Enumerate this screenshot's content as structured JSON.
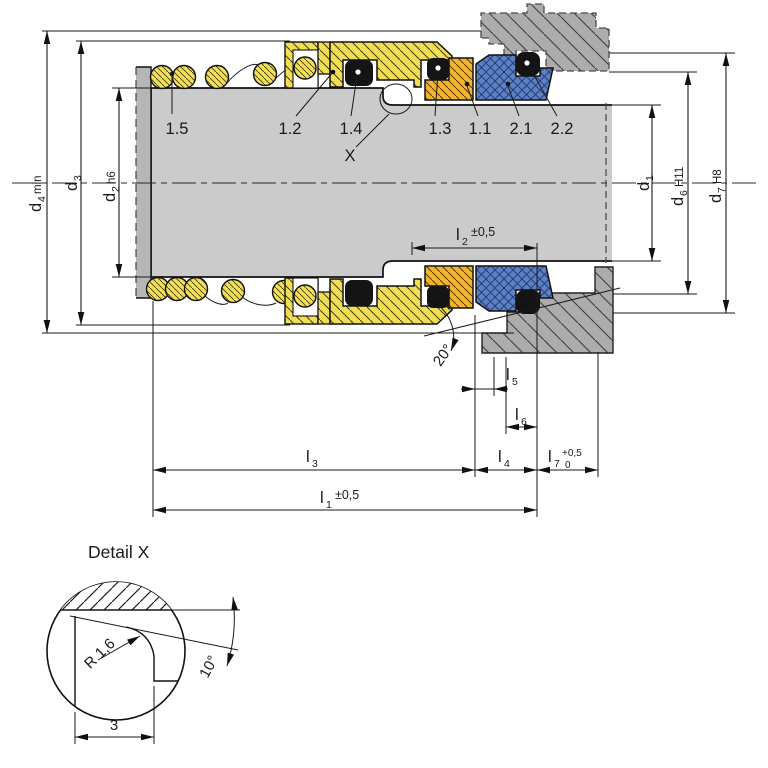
{
  "parts": {
    "p15": "1.5",
    "p12": "1.2",
    "p14": "1.4",
    "p13": "1.3",
    "p11": "1.1",
    "p21": "2.1",
    "p22": "2.2",
    "x_ref": "X"
  },
  "dims": {
    "d4": {
      "base": "d",
      "sub": "4",
      "tol": "min"
    },
    "d3": {
      "base": "d",
      "sub": "3",
      "tol": ""
    },
    "d2": {
      "base": "d",
      "sub": "2",
      "tol": "h6"
    },
    "d1": {
      "base": "d",
      "sub": "1",
      "tol": ""
    },
    "d6": {
      "base": "d",
      "sub": "6",
      "tol": "H11"
    },
    "d7": {
      "base": "d",
      "sub": "7",
      "tol": "H8"
    },
    "l1": {
      "base": "l",
      "sub": "1",
      "tol": "±0,5"
    },
    "l2": {
      "base": "l",
      "sub": "2",
      "tol": "±0,5"
    },
    "l3": {
      "base": "l",
      "sub": "3",
      "tol": ""
    },
    "l4": {
      "base": "l",
      "sub": "4",
      "tol": ""
    },
    "l5": {
      "base": "l",
      "sub": "5",
      "tol": ""
    },
    "l6": {
      "base": "l",
      "sub": "6",
      "tol": ""
    },
    "l7": {
      "base": "l",
      "sub": "7",
      "tol_upper": "+0,5",
      "tol_lower": "0"
    }
  },
  "angles": {
    "seat": "20°",
    "undercut": "10°"
  },
  "detail": {
    "title": "Detail X",
    "radius": "R 1,6",
    "groove_width": "3"
  },
  "colors": {
    "part_yellow": "#f2de52",
    "part_gold": "#f2b42c",
    "part_blue": "#5e81c4",
    "shaft_gray": "#cbcbcb",
    "housing_gray": "#acacac",
    "collar_gray": "#b6b6b6",
    "oring_black": "#141414"
  }
}
